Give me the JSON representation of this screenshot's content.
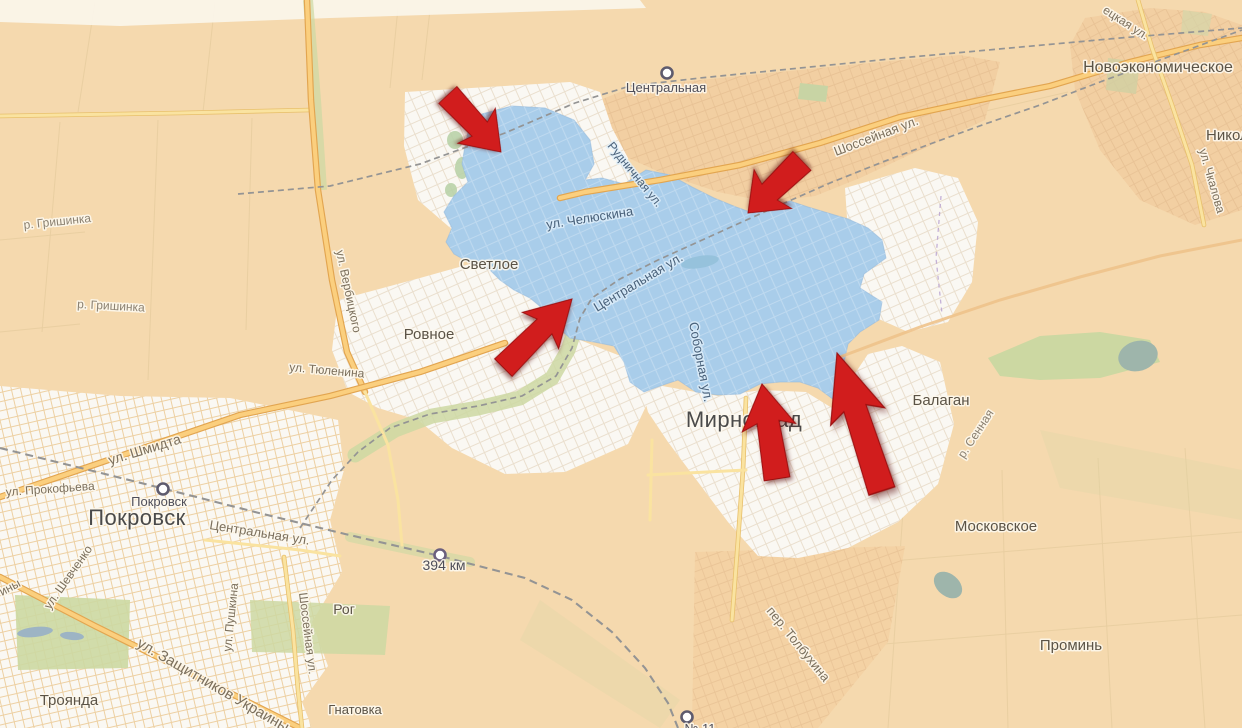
{
  "canvas": {
    "width": 1242,
    "height": 728
  },
  "map": {
    "kind": "street-map",
    "highlighted_zone": "blue shaded area over central Myrnohrad",
    "annotation": "five red arrows pointing into the highlighted zone"
  },
  "colors": {
    "background": "#f5d9ae",
    "fields_light": "#f9e5c4",
    "urban_tan": "#f2cfa2",
    "urban_white": "#faf8f3",
    "zone_blue": "#a9cdea",
    "greenery": "#ccd8a2",
    "water": "#9eb5ab",
    "road_fill": "#fbcf7e",
    "road_casing": "#e2a550",
    "railway_gray": "#949494",
    "arrow_red": "#d11d1d"
  },
  "settlements": [
    {
      "name": "Новоэкономическое"
    },
    {
      "name": "Никол"
    },
    {
      "name": "Светлое"
    },
    {
      "name": "Ровное"
    },
    {
      "name": "Мирноград"
    },
    {
      "name": "Покровск"
    },
    {
      "name": "Балаган"
    },
    {
      "name": "Московское"
    },
    {
      "name": "Проминь"
    },
    {
      "name": "Рог"
    },
    {
      "name": "Троянда"
    },
    {
      "name": "Гнатовка"
    }
  ],
  "stations": [
    {
      "name": "Центральная"
    },
    {
      "name": "Покровск"
    },
    {
      "name": "394 км"
    },
    {
      "name": "№ 11"
    }
  ],
  "streets": [
    {
      "name": "ецкая ул."
    },
    {
      "name": "ул. Чкалова"
    },
    {
      "name": "Шоссейная ул."
    },
    {
      "name": "Рудничная ул."
    },
    {
      "name": "ул. Челюскина"
    },
    {
      "name": "Центральная ул."
    },
    {
      "name": "Соборная ул."
    },
    {
      "name": "ул. Вербицкого"
    },
    {
      "name": "ул. Тюленина"
    },
    {
      "name": "ул. Шмидта"
    },
    {
      "name": "ул. Прокофьева"
    },
    {
      "name": "Центральная ул."
    },
    {
      "name": "ул. Шевченко"
    },
    {
      "name": "ул. Пушкина"
    },
    {
      "name": "Шоссейная ул."
    },
    {
      "name": "ул. Защитников Украины"
    },
    {
      "name": "пер. Толбухина"
    },
    {
      "name": "ины"
    }
  ],
  "rivers": [
    {
      "name": "р. Гришинка"
    },
    {
      "name": "р. Гришинка"
    },
    {
      "name": "р. Сенная"
    }
  ],
  "arrows": [
    {
      "id": 1,
      "direction": "southeast"
    },
    {
      "id": 2,
      "direction": "southwest"
    },
    {
      "id": 3,
      "direction": "northeast"
    },
    {
      "id": 4,
      "direction": "north"
    },
    {
      "id": 5,
      "direction": "north-northwest"
    }
  ]
}
